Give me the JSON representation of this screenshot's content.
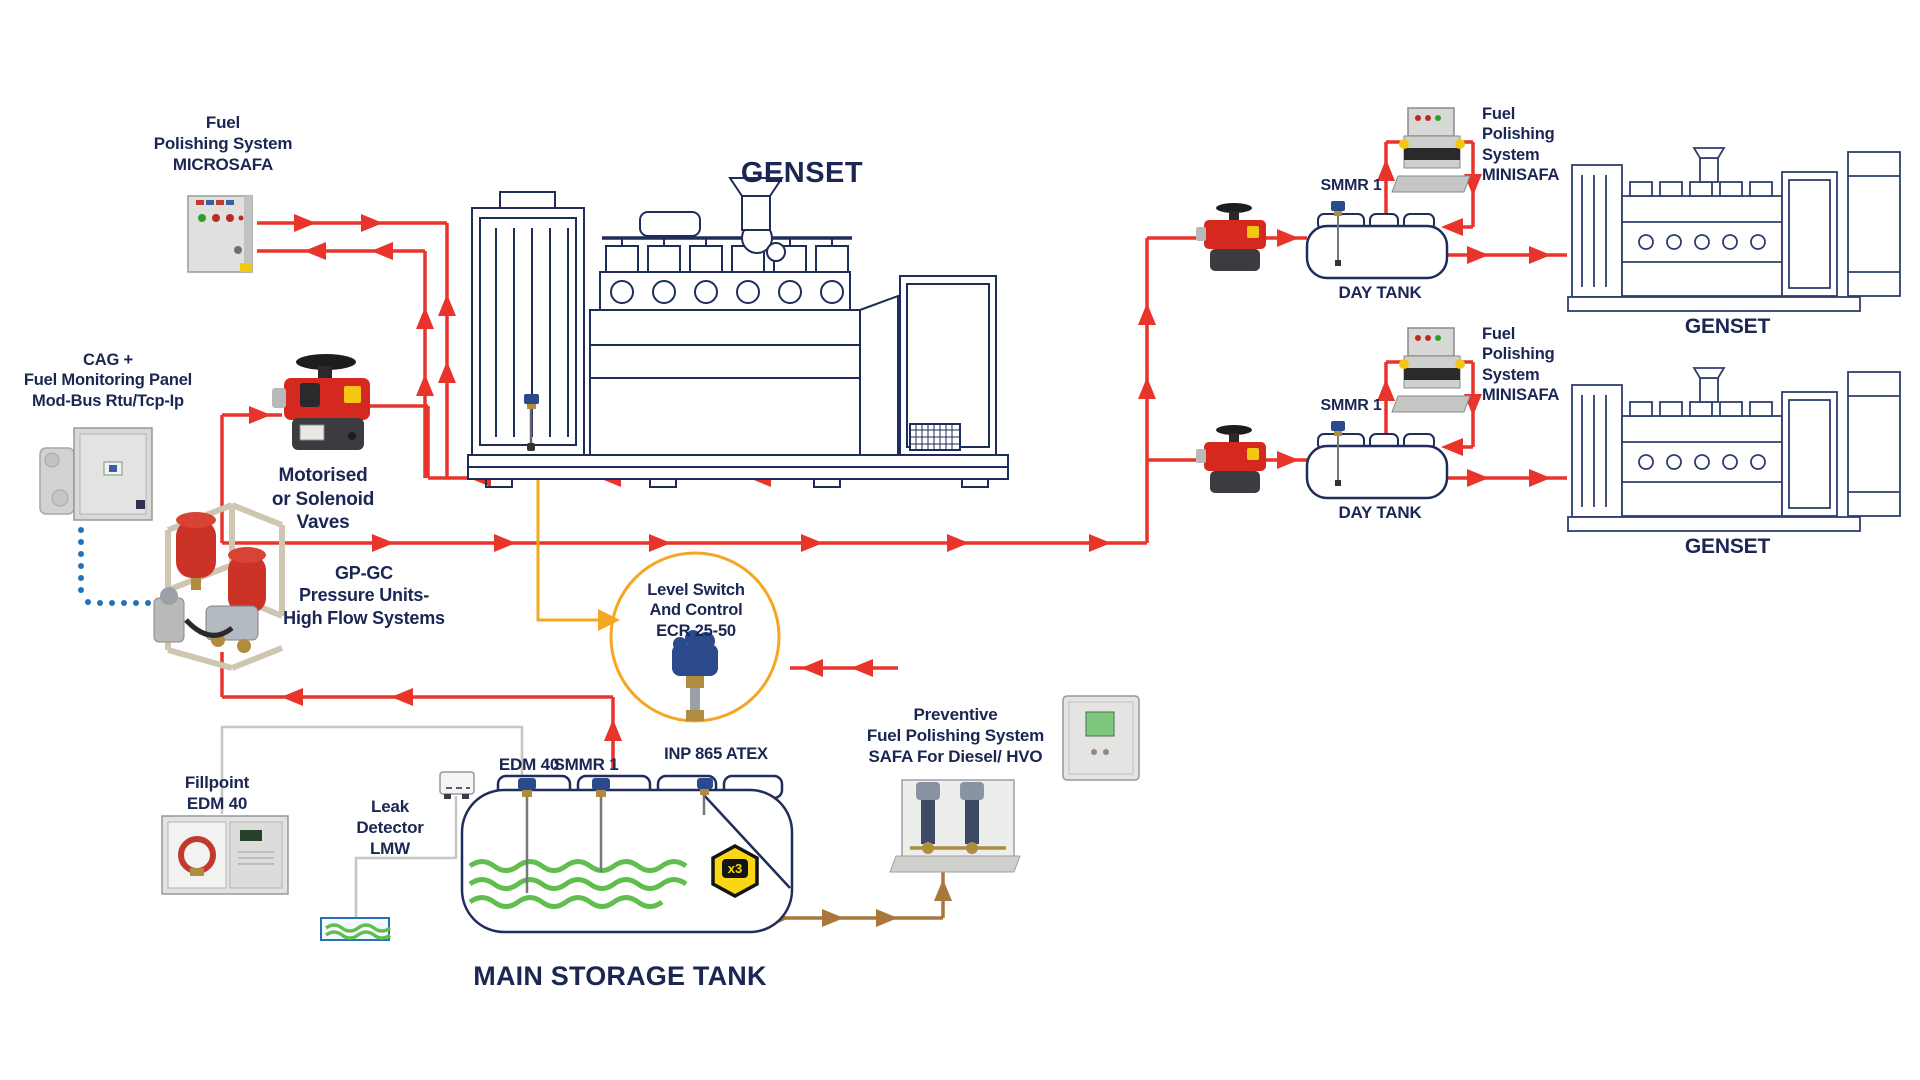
{
  "colors": {
    "navy": "#1b2653",
    "red": "#e9342c",
    "orange": "#f5a623",
    "brown": "#a9773b",
    "green": "#62bd4f",
    "blue": "#2471b8",
    "yellow": "#f9d616",
    "grayline": "#c6c6c4",
    "valve_red": "#d5281e",
    "valve_base": "#3c3c40",
    "panel_gray": "#e0e0de"
  },
  "titles": {
    "genset_main": "GENSET",
    "main_storage_tank": "MAIN STORAGE TANK",
    "genset_right_top": "GENSET",
    "genset_right_bottom": "GENSET"
  },
  "labels": {
    "microsafa": {
      "lines": [
        "Fuel",
        "Polishing System",
        "MICROSAFA"
      ]
    },
    "cag": {
      "lines": [
        "CAG +",
        "Fuel Monitoring Panel",
        "Mod-Bus Rtu/Tcp-Ip"
      ]
    },
    "valves": {
      "lines": [
        "Motorised",
        "or Solenoid",
        "Vaves"
      ]
    },
    "gpgc": {
      "lines": [
        "GP-GC",
        "Pressure Units-",
        "High Flow Systems"
      ]
    },
    "level_switch": {
      "lines": [
        "Level Switch",
        "And Control",
        "ECR 25-50"
      ]
    },
    "fillpoint": {
      "lines": [
        "Fillpoint",
        "EDM 40"
      ]
    },
    "leak_detector": {
      "lines": [
        "Leak",
        "Detector",
        "LMW"
      ]
    },
    "tank_sensors": {
      "edm40": "EDM 40",
      "smmr1": "SMMR 1"
    },
    "inp": "INP 865 ATEX",
    "x3_badge": "x3",
    "preventive": {
      "lines": [
        "Preventive",
        "Fuel Polishing System",
        "SAFA For Diesel/ HVO"
      ]
    },
    "day_top": {
      "smmr1": "SMMR 1",
      "day_tank": "DAY TANK",
      "fps": [
        "Fuel",
        "Polishing",
        "System",
        "MINISAFA"
      ]
    },
    "day_bottom": {
      "smmr1": "SMMR 1",
      "day_tank": "DAY TANK",
      "fps": [
        "Fuel",
        "Polishing",
        "System",
        "MINISAFA"
      ]
    }
  }
}
